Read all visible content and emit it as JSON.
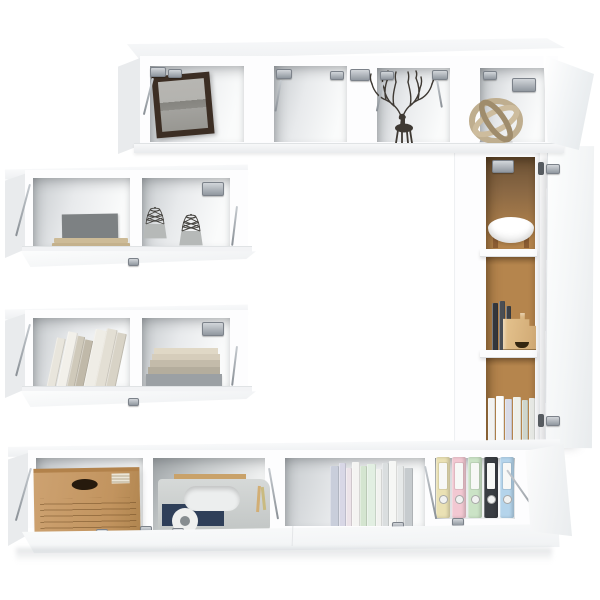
{
  "scene": {
    "kind": "furniture-product-photo",
    "subject": "6-piece white wall-mounted TV wall unit set with open flip doors, styled with decor props",
    "background": "#ffffff",
    "palette": {
      "white-panel": "#fdfdfe",
      "panel-side": "#e9ebed",
      "panel-edge": "#e0e3e6",
      "inner-shade": "#c7cbce",
      "metal": "#aab0b6",
      "metal-dark": "#60666c",
      "brown-back": "#b5854d",
      "brown-back-dark": "#6b5134",
      "frame-brown": "#3c2e24",
      "photo-sky": "#b4b3af",
      "photo-hill": "#85847f",
      "photo-ground": "#a3a29e",
      "cardboard": "#c79b67",
      "cardboard-line": "#9d763f",
      "filebox": "#dcb780",
      "toolbox": "#ccd0cf",
      "navy": "#2f3f59",
      "wood": "#c9a26a",
      "stand-brown": "#9a6a3c",
      "wire": "#45433f",
      "basket-base": "#b6b9b8",
      "sphere-light": "#cdbc9d",
      "sphere-mid": "#bfae8f",
      "sphere-dark": "#9f8c6c",
      "deer": "#3e3933"
    },
    "units": [
      {
        "name": "top-wall-cabinet",
        "doors": "flip-up, open",
        "contents": [
          "framed landscape picture",
          "empty compartment",
          "deer antler ornament",
          "wooden sphere ornament"
        ]
      },
      {
        "name": "upper-left-wall-shelf",
        "doors": "flip-down, open",
        "contents": [
          "grey book on beige book stack",
          "two wire basket ornaments"
        ]
      },
      {
        "name": "lower-left-wall-shelf",
        "doors": "flip-down, open",
        "contents": [
          "row of leaning books",
          "stack of books"
        ]
      },
      {
        "name": "tall-right-cabinet",
        "doors": "side-hinged, open",
        "contents": [
          "white bowl on wooden stand",
          "dark books with cardboard file box",
          "row of pale books"
        ]
      },
      {
        "name": "bottom-tv-bench",
        "doors": "flip-down, open",
        "contents": [
          "cardboard storage box",
          "grey toy box with pencils",
          "row of pastel books",
          "five ring binders"
        ]
      }
    ],
    "books": {
      "unit2_gray_book": "#7d8183",
      "unit2_stack": [
        "#cdbb97",
        "#c4b18c"
      ],
      "unit3_leaning": [
        "#e8e5dc",
        "#f2f0ea",
        "#cfc9ba",
        "#c0b9a9",
        "#efede6",
        "#e3dfd4",
        "#d8d3c6"
      ],
      "unit3_stack": [
        "#e0d8c6",
        "#d6cdbb",
        "#c3bbaa",
        "#b4ad9d",
        "#9ba0a4"
      ],
      "tall_dark": [
        "#33363b",
        "#4a4e54",
        "#3c4046"
      ],
      "tall_bottom": [
        "#f2f2f0",
        "#fbfbf9",
        "#d8dae6",
        "#eef0ea",
        "#cfd6cc",
        "#e6e8e4"
      ],
      "bottom_row": [
        "#c9cedb",
        "#d8d7e6",
        "#ece3e9",
        "#f4f4f2",
        "#d4e5d0",
        "#e2efe2",
        "#f1f2ef",
        "#dadedf",
        "#f6f7f5",
        "#e6e9e9",
        "#c6cbce"
      ]
    },
    "binders": [
      "#eae1b4",
      "#f2c8d2",
      "#cbe3c6",
      "#3a3e43",
      "#b4d4eb"
    ]
  }
}
